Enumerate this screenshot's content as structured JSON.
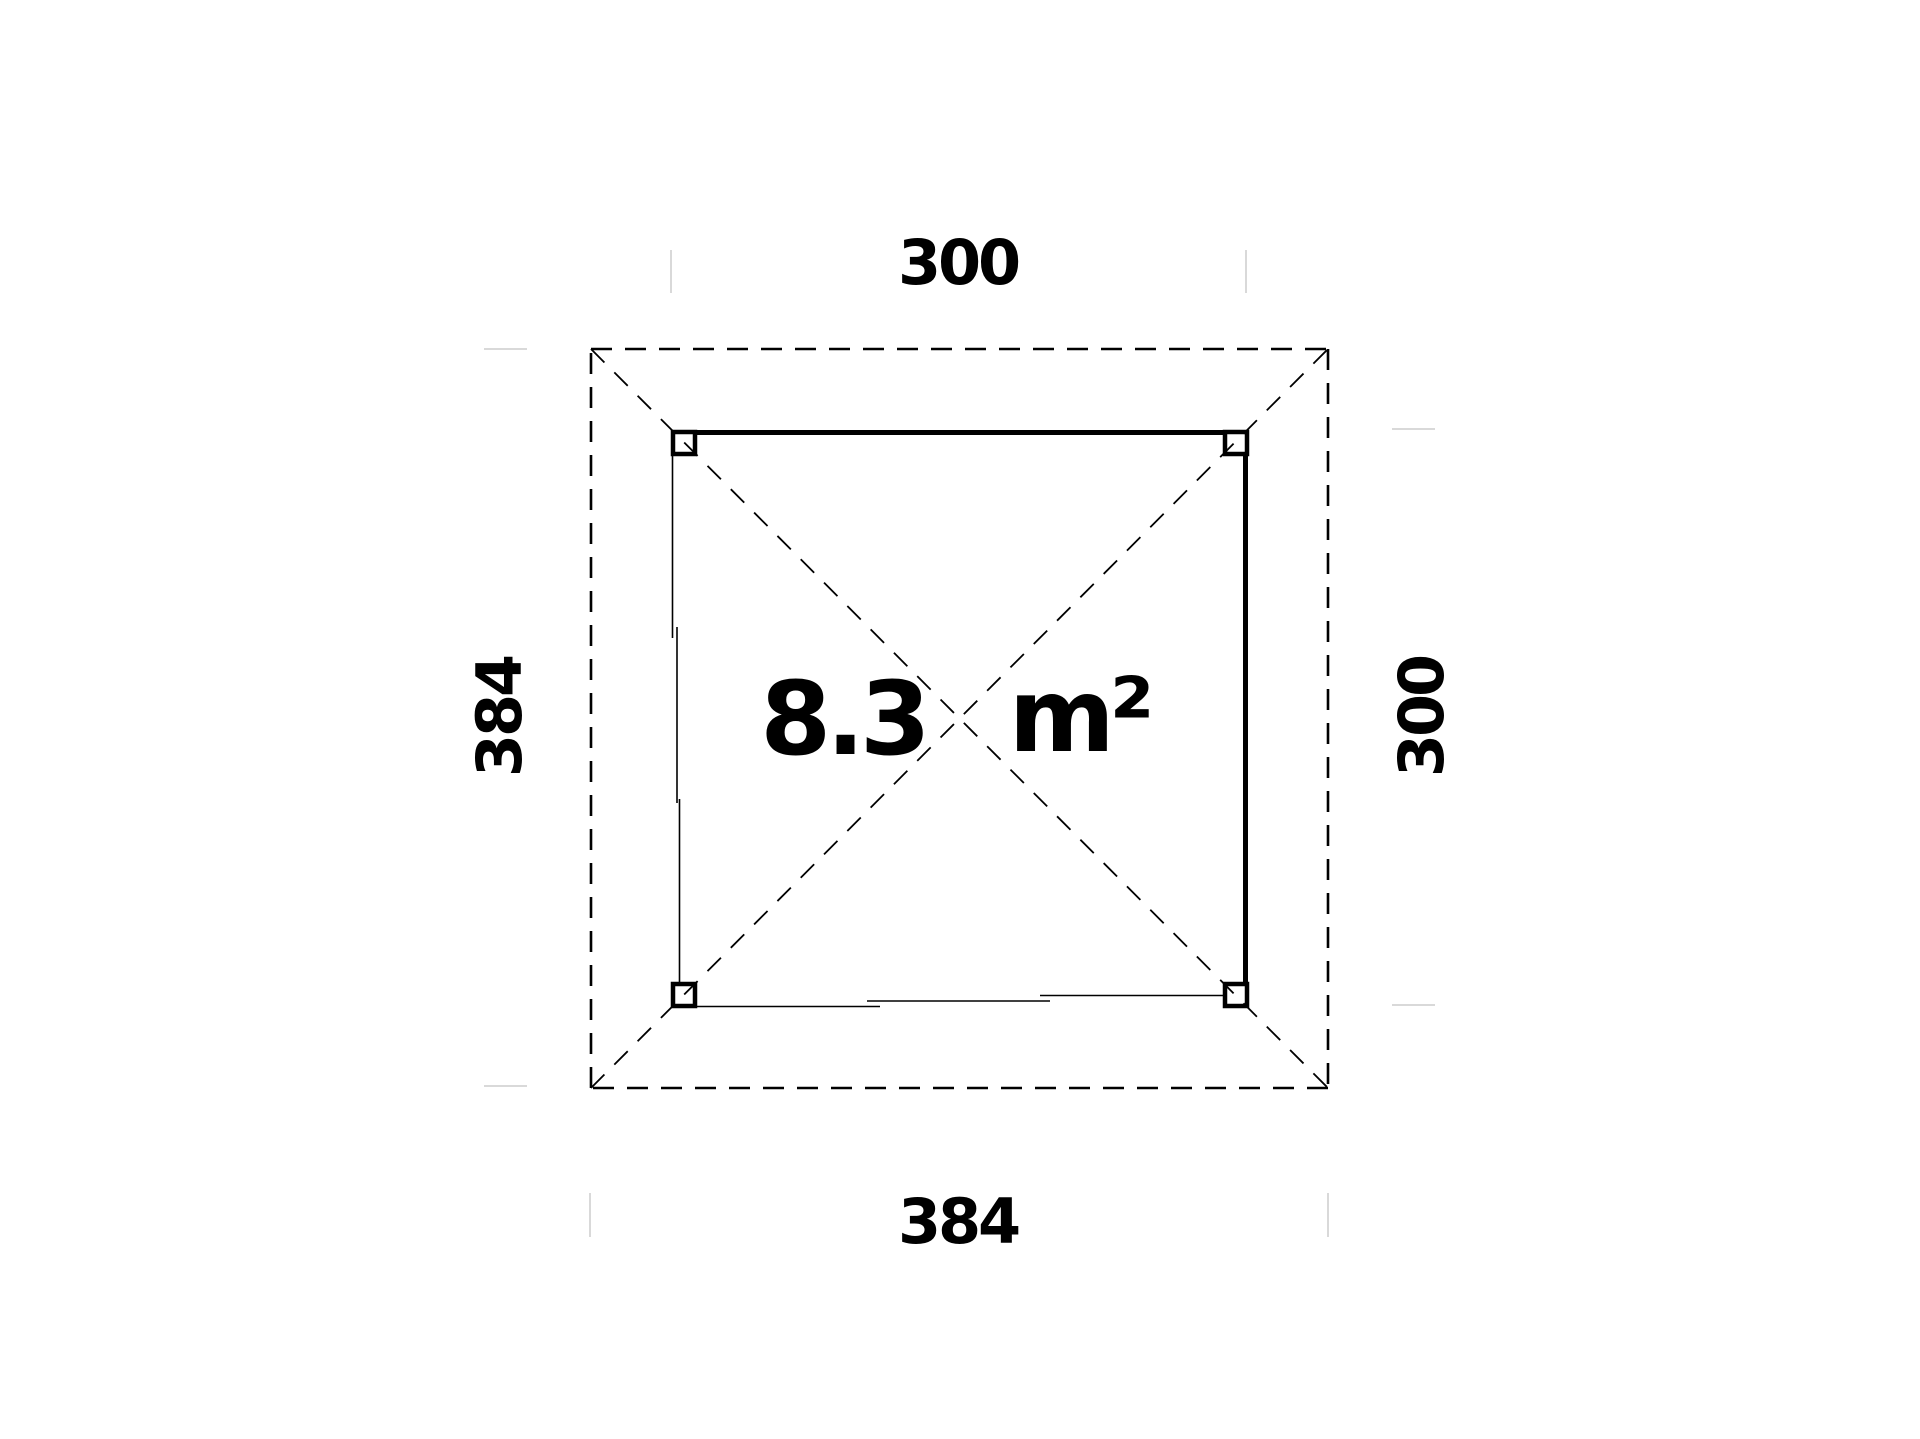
{
  "page": {
    "background": "#ffffff"
  },
  "plan": {
    "area": {
      "value": "8.3",
      "unit": "m²"
    },
    "dimensions": {
      "top": "300",
      "right": "300",
      "bottom": "384",
      "left": "384"
    },
    "colors": {
      "line": "#000000",
      "extension_tick": "#d9d9d9",
      "text": "#000000"
    }
  }
}
